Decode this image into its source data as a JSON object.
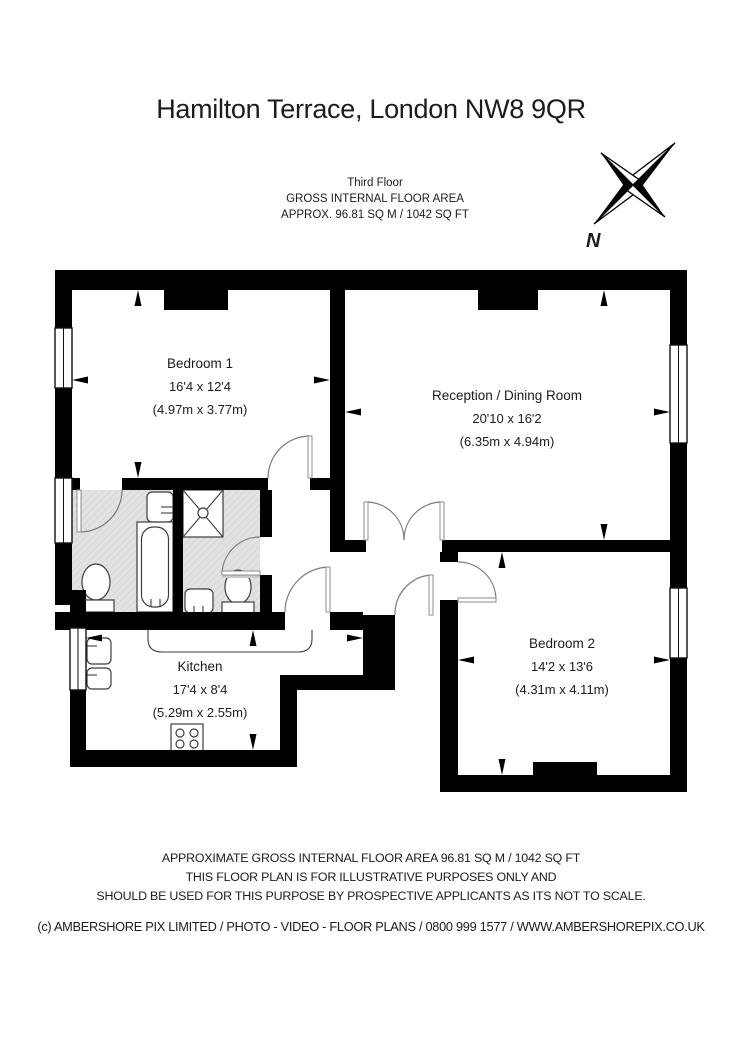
{
  "header": {
    "title": "Hamilton Terrace, London NW8 9QR",
    "floor": "Third Floor",
    "gia": "GROSS INTERNAL FLOOR AREA",
    "approx": "APPROX. 96.81 SQ M / 1042 SQ FT"
  },
  "compass": {
    "north": "N"
  },
  "rooms": {
    "bedroom1": {
      "name": "Bedroom 1",
      "imperial": "16'4 x 12'4",
      "metric": "(4.97m x 3.77m)"
    },
    "reception": {
      "name": "Reception / Dining Room",
      "imperial": "20'10 x 16'2",
      "metric": "(6.35m x 4.94m)"
    },
    "bedroom2": {
      "name": "Bedroom 2",
      "imperial": "14'2 x 13'6",
      "metric": "(4.31m x 4.11m)"
    },
    "kitchen": {
      "name": "Kitchen",
      "imperial": "17'4 x 8'4",
      "metric": "(5.29m x 2.55m)"
    }
  },
  "footer": {
    "line1": "APPROXIMATE GROSS INTERNAL FLOOR AREA 96.81 SQ M / 1042 SQ FT",
    "line2": "THIS FLOOR PLAN IS FOR ILLUSTRATIVE PURPOSES ONLY AND",
    "line3": "SHOULD BE USED FOR THIS PURPOSE BY PROSPECTIVE APPLICANTS AS ITS NOT TO SCALE.",
    "copyright": "(c) AMBERSHORE PIX LIMITED / PHOTO - VIDEO - FLOOR PLANS / 0800 999 1577 / WWW.AMBERSHOREPIX.CO.UK"
  },
  "colors": {
    "wall": "#000000",
    "bathroom_floor": "#e2e2e2",
    "hatch_line": "#cdcdcd"
  }
}
